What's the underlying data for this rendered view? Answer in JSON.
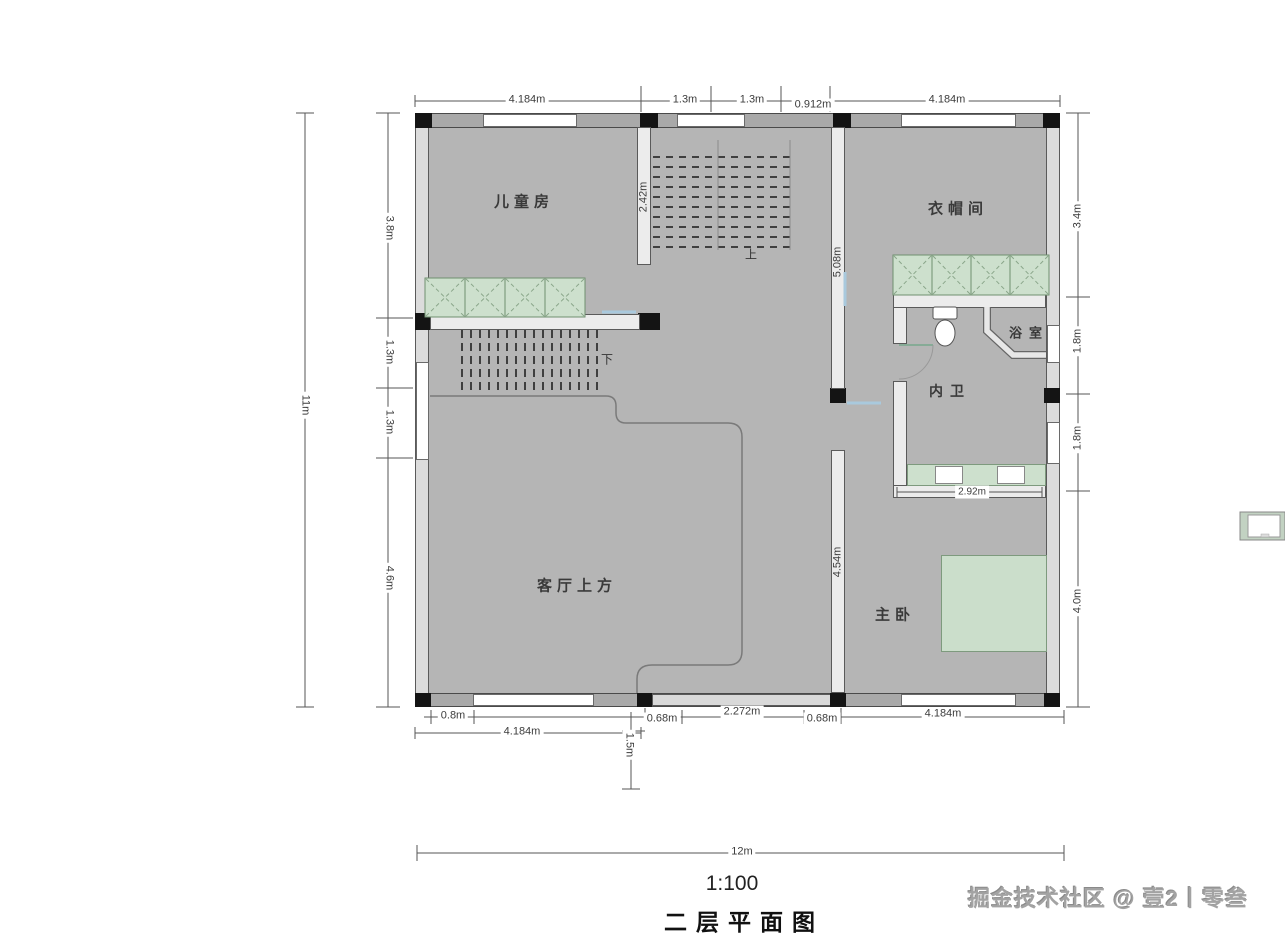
{
  "rooms": {
    "kids": "儿童房",
    "cloak": "衣帽间",
    "bath": "浴室",
    "ensuite": "内卫",
    "void": "客厅上方",
    "master": "主卧"
  },
  "stairs": {
    "up": "上",
    "down": "下"
  },
  "dims": {
    "top": [
      "4.184m",
      "1.3m",
      "1.3m",
      "0.912m",
      "4.184m"
    ],
    "left_overall": "11m",
    "left": [
      "3.8m",
      "1.3m",
      "1.3m",
      "4.6m"
    ],
    "right": [
      "3.4m",
      "1.8m",
      "1.8m",
      "4.0m"
    ],
    "bottom": [
      "0.8m",
      "0.68m",
      "2.272m",
      "0.68m",
      "4.184m"
    ],
    "bottom_left_bay": "4.184m",
    "bottom_offset": "1.5m",
    "bottom_overall": "12m",
    "inner_stair": "2.42m",
    "inner_hall": "5.08m",
    "inner_wall": "4.54m",
    "inner_vanity": "2.92m"
  },
  "footer": {
    "scale": "1:100",
    "title": "二层平面图"
  },
  "watermark": "掘金技术社区 @ 壹2丨零叁",
  "colors": {
    "floor": "#b5b5b5",
    "wall_dark": "#a9a9a9",
    "wall_light": "#ececec",
    "fixture_green": "#cde0cd",
    "accent_blue": "#a9c9dd"
  }
}
